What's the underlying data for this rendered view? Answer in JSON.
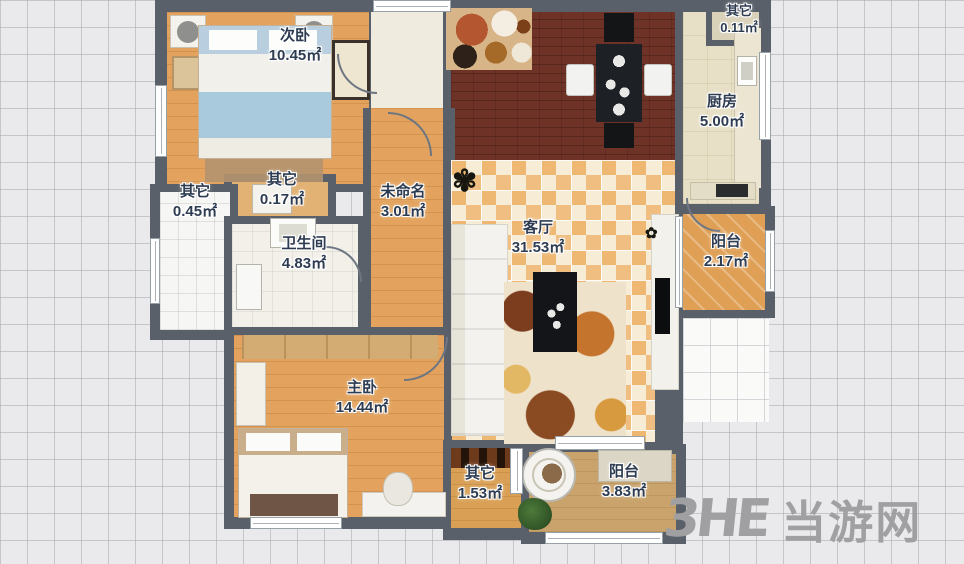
{
  "plan": {
    "rooms": {
      "secondary_bedroom": {
        "name": "次卧",
        "area": "10.45㎡"
      },
      "other_top_right": {
        "name": "其它",
        "area": "0.11㎡"
      },
      "kitchen": {
        "name": "厨房",
        "area": "5.00㎡"
      },
      "other_left_small": {
        "name": "其它",
        "area": "0.45㎡"
      },
      "other_closet": {
        "name": "其它",
        "area": "0.17㎡"
      },
      "unnamed": {
        "name": "未命名",
        "area": "3.01㎡"
      },
      "bathroom": {
        "name": "卫生间",
        "area": "4.83㎡"
      },
      "living_room": {
        "name": "客厅",
        "area": "31.53㎡"
      },
      "balcony_right": {
        "name": "阳台",
        "area": "2.17㎡"
      },
      "master_bedroom": {
        "name": "主卧",
        "area": "14.44㎡"
      },
      "other_bottom": {
        "name": "其它",
        "area": "1.53㎡"
      },
      "balcony_bottom": {
        "name": "阳台",
        "area": "3.83㎡"
      }
    },
    "colors": {
      "wall": "#5a6069",
      "wood_floor": "#e3a35e",
      "dining_floor": "#6f3226",
      "living_tile_base": "#f7ecd6",
      "living_tile_accent": "#efbe80",
      "kitchen_floor": "#e7e0c6",
      "balcony_bottom_floor": "#c9a36b",
      "label_text": "#2e3c52",
      "grid_background": "#eaeaec"
    },
    "icons": {
      "plant_living": "✾",
      "plant_tv": "✿"
    }
  },
  "watermark": {
    "logo": "3HE",
    "site": "当游网"
  }
}
